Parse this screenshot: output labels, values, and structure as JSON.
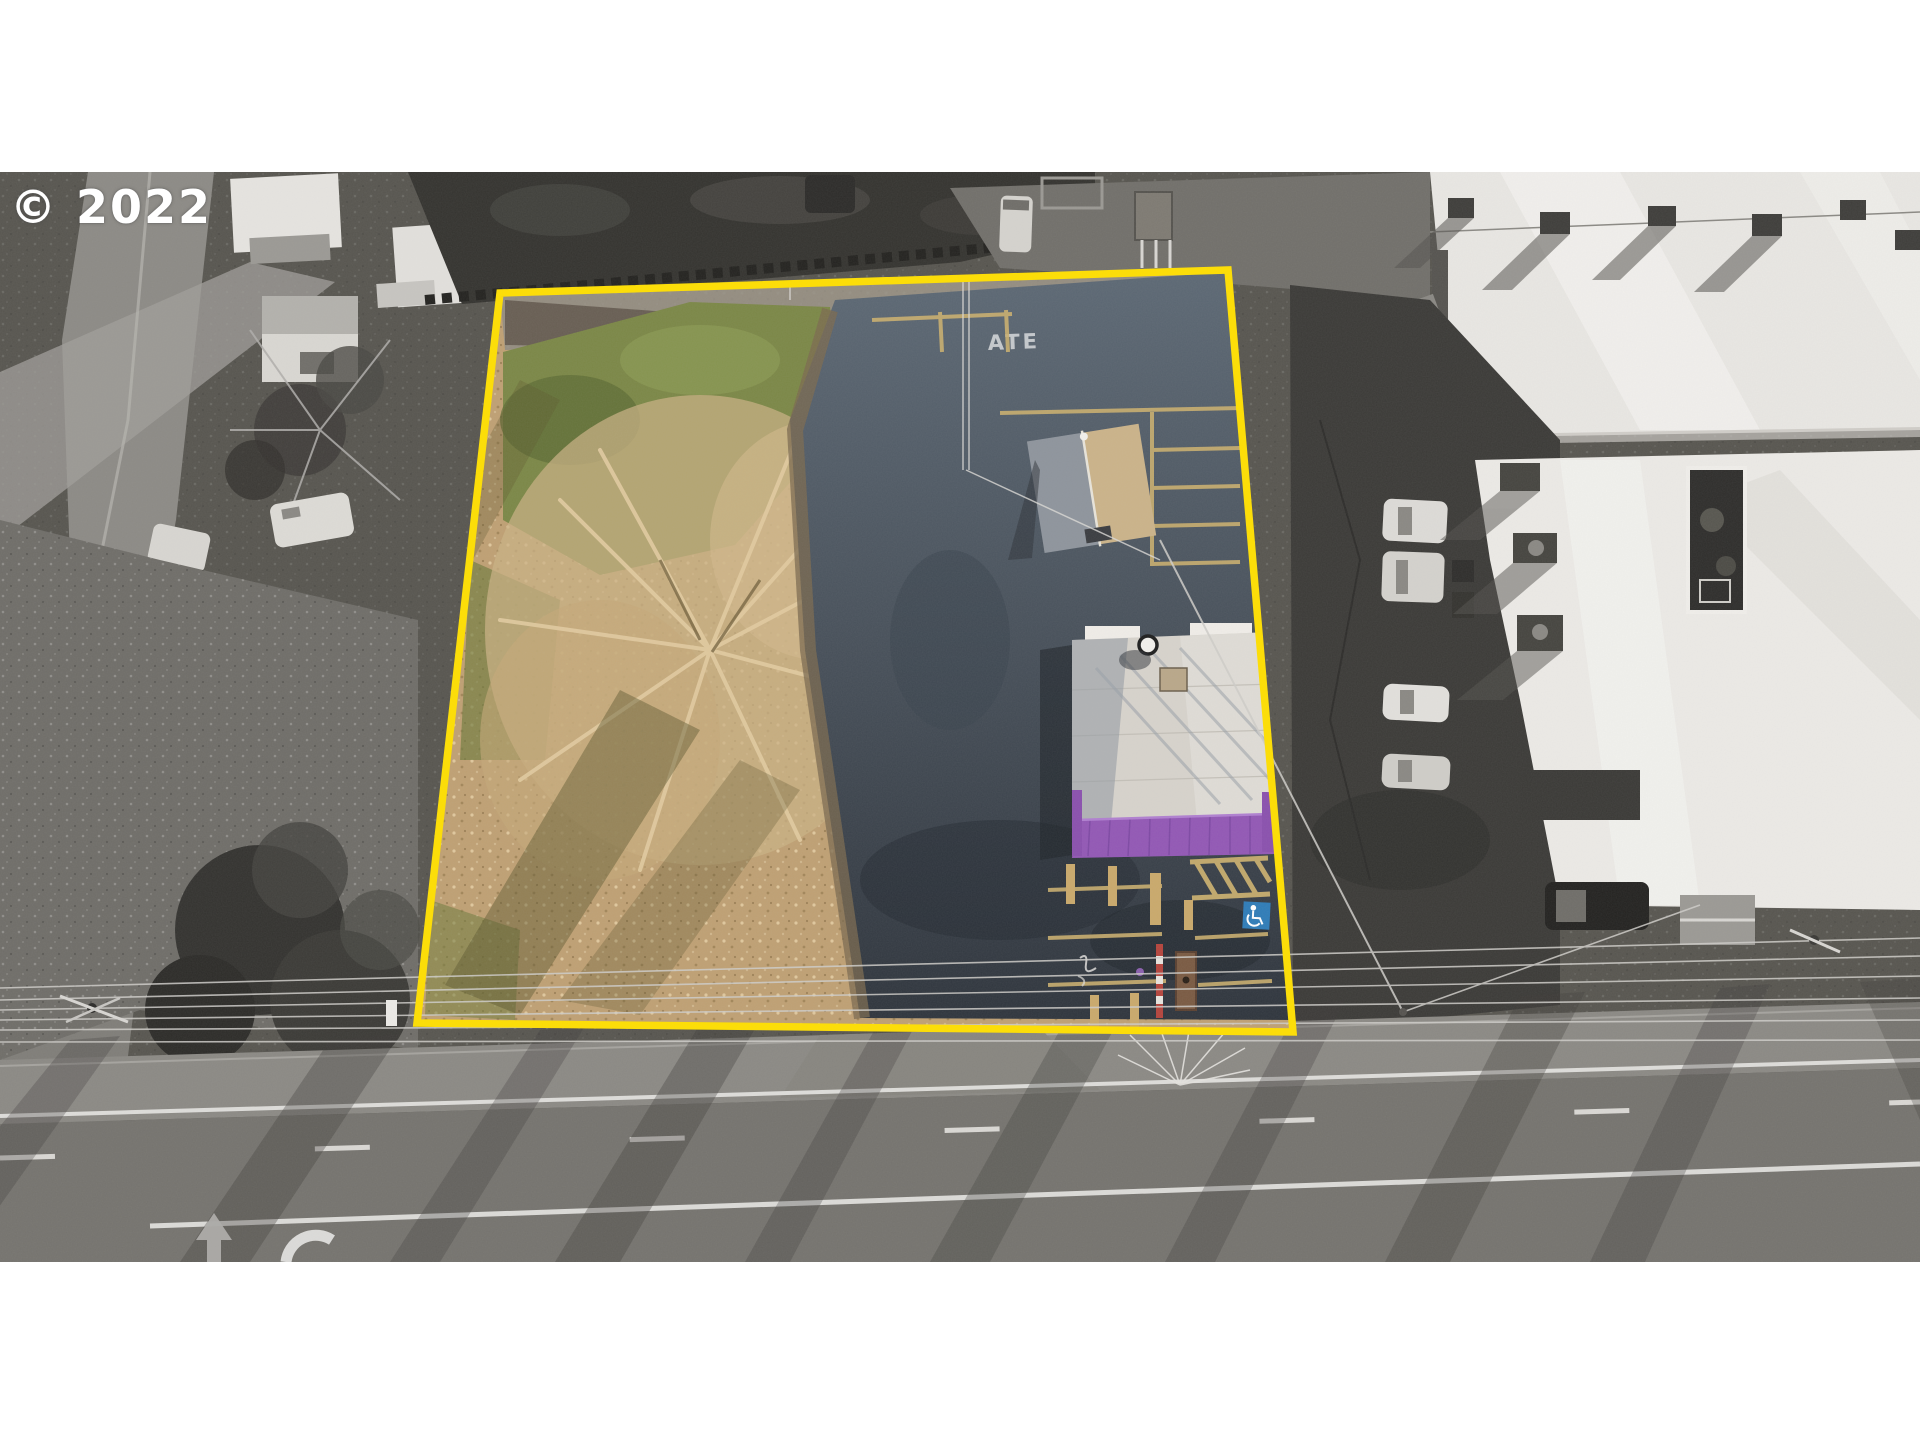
{
  "watermark": {
    "text": "© 2022"
  },
  "pavement_markings": {
    "faded_text": "ATE"
  },
  "colors": {
    "boundary_yellow": "#ffdf00",
    "awning_purple": "#9257b5",
    "accessible_blue": "#2e7cb8",
    "grass_green": "#7b8746",
    "leaf_tan": "#bfa073",
    "curb_paint_tan": "#c9ae6e",
    "roof_white": "#d8d4cd",
    "letterbox_white": "#ffffff"
  }
}
